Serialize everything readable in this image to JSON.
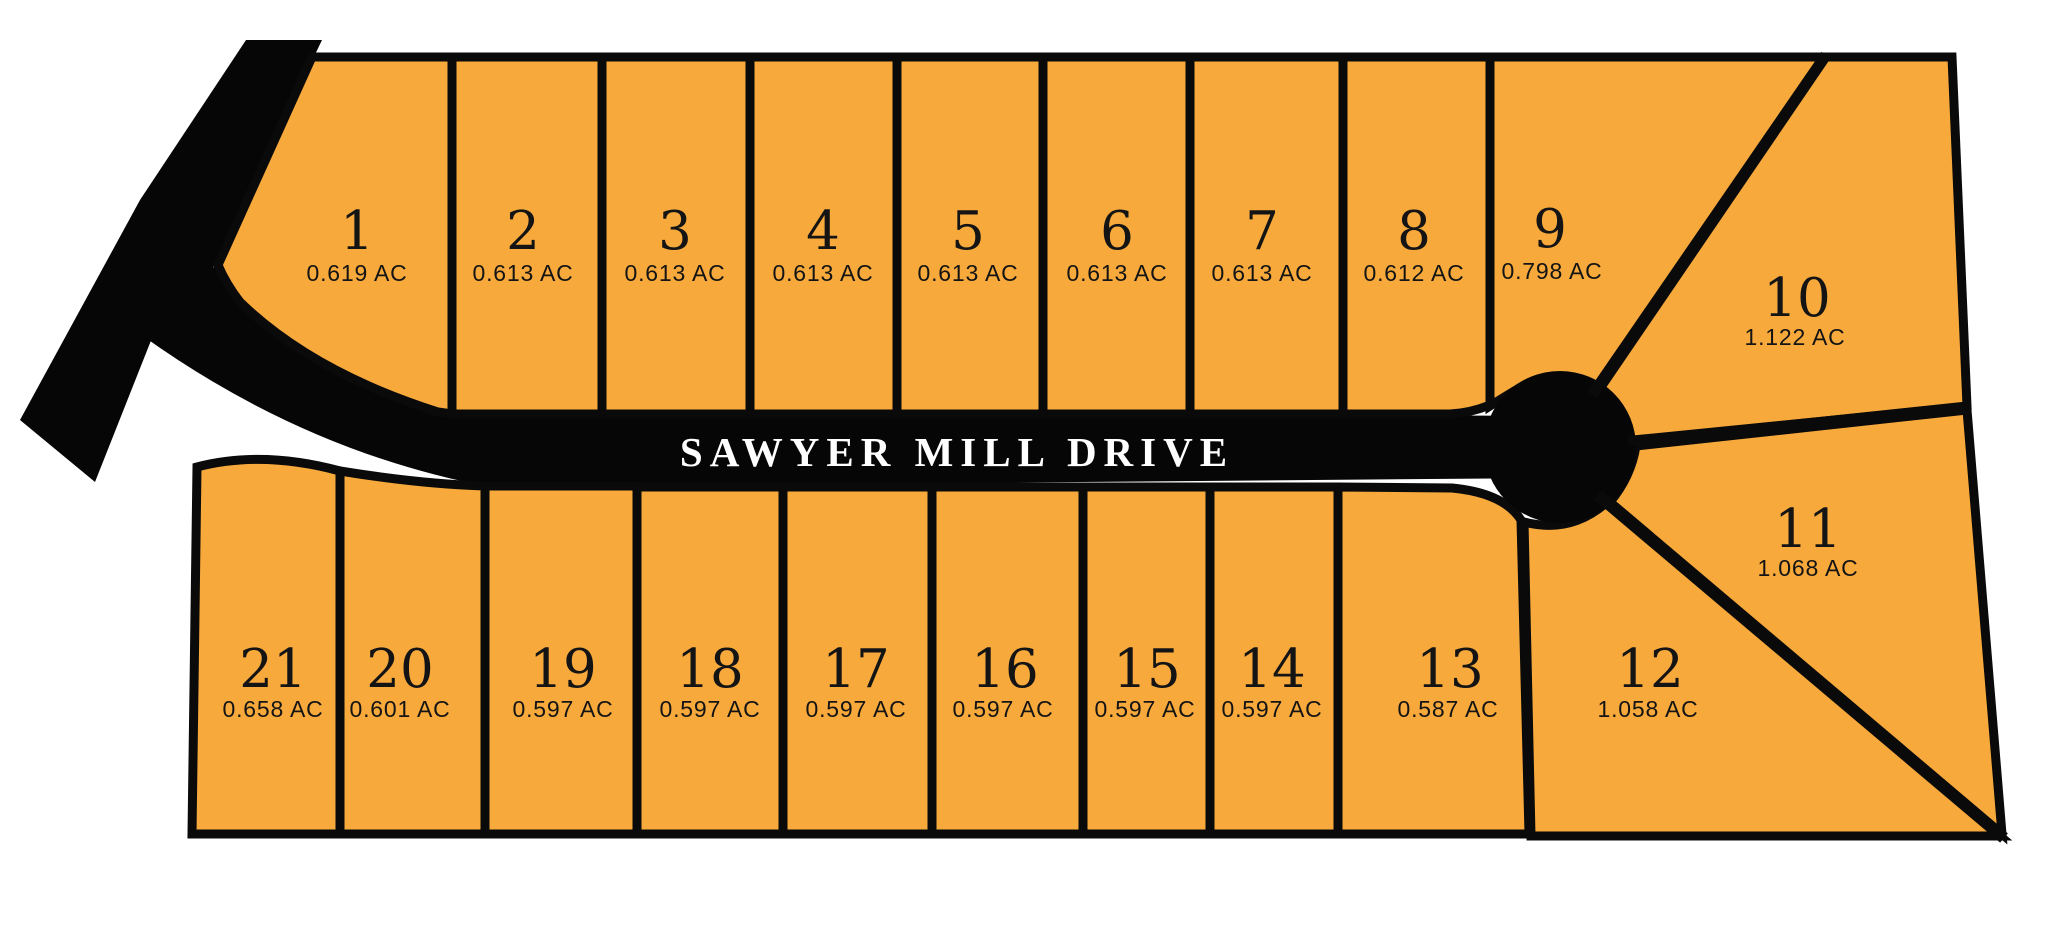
{
  "road": {
    "name": "SAWYER MILL DRIVE"
  },
  "colors": {
    "background": "#ffffff",
    "lot_fill": "#F7A93C",
    "road_fill": "#060606",
    "outline": "#0a0a0a",
    "label_text": "#141414",
    "road_text": "#ffffff"
  },
  "area_unit": "AC",
  "lots": [
    {
      "number": "1",
      "area": "0.619 AC"
    },
    {
      "number": "2",
      "area": "0.613 AC"
    },
    {
      "number": "3",
      "area": "0.613 AC"
    },
    {
      "number": "4",
      "area": "0.613 AC"
    },
    {
      "number": "5",
      "area": "0.613 AC"
    },
    {
      "number": "6",
      "area": "0.613 AC"
    },
    {
      "number": "7",
      "area": "0.613 AC"
    },
    {
      "number": "8",
      "area": "0.612 AC"
    },
    {
      "number": "9",
      "area": "0.798 AC"
    },
    {
      "number": "10",
      "area": "1.122 AC"
    },
    {
      "number": "11",
      "area": "1.068 AC"
    },
    {
      "number": "12",
      "area": "1.058 AC"
    },
    {
      "number": "13",
      "area": "0.587 AC"
    },
    {
      "number": "14",
      "area": "0.597 AC"
    },
    {
      "number": "15",
      "area": "0.597 AC"
    },
    {
      "number": "16",
      "area": "0.597 AC"
    },
    {
      "number": "17",
      "area": "0.597 AC"
    },
    {
      "number": "18",
      "area": "0.597 AC"
    },
    {
      "number": "19",
      "area": "0.597 AC"
    },
    {
      "number": "20",
      "area": "0.601 AC"
    },
    {
      "number": "21",
      "area": "0.658 AC"
    }
  ]
}
